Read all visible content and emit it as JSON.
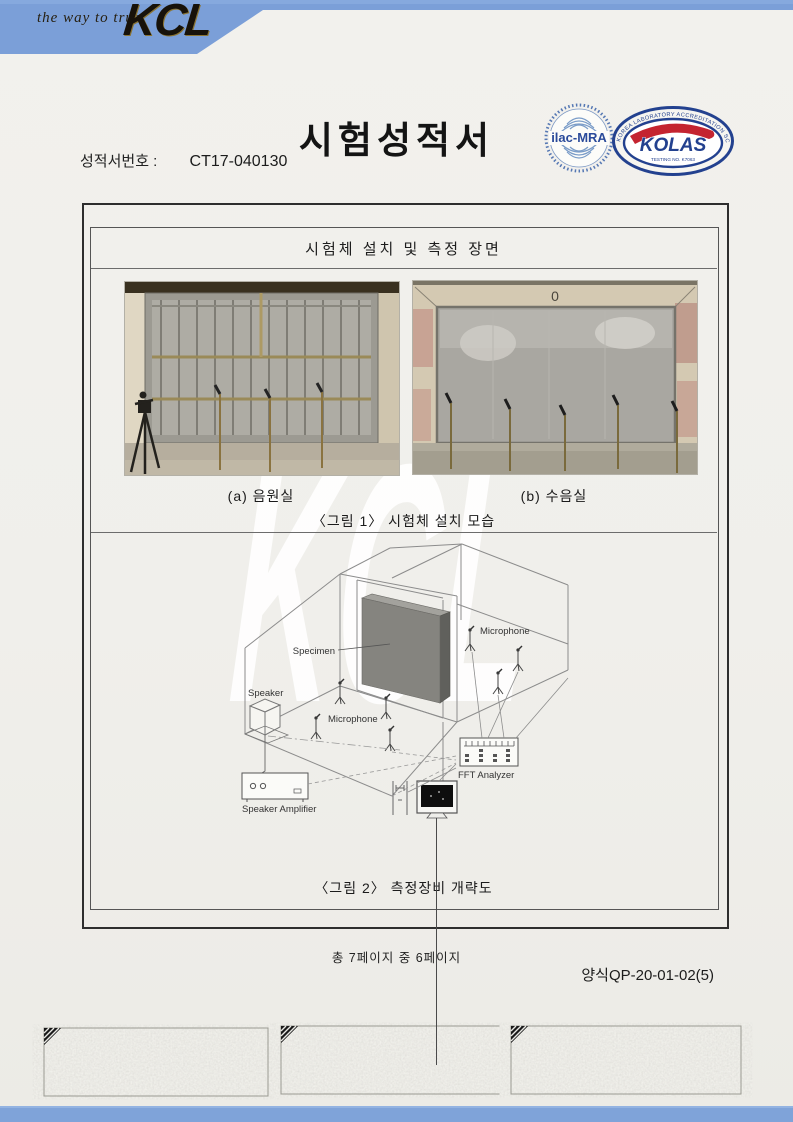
{
  "header": {
    "tagline": "the way to trust",
    "brand": "KCL"
  },
  "title": "시험성적서",
  "report": {
    "label": "성적서번호 :",
    "number": "CT17-040130"
  },
  "certifications": {
    "ilac": {
      "label": "ilac-MRA"
    },
    "kolas": {
      "name": "KOLAS",
      "ring_text": "KOREA LABORATORY ACCREDITATION SCHEME",
      "testing_no": "TESTING NO. K7063"
    }
  },
  "figure_box": {
    "title": "시험체 설치 및 측정 장면",
    "photos": {
      "a": {
        "caption": "(a) 음원실"
      },
      "b": {
        "caption": "(b) 수음실",
        "wall_mark": "0"
      }
    },
    "fig1_caption": "〈그림 1〉 시험체 설치 모습",
    "fig2_caption": "〈그림 2〉 측정장비 개략도",
    "diagram": {
      "labels": {
        "specimen": "Specimen",
        "microphone_receiving": "Microphone",
        "microphone_source": "Microphone",
        "speaker": "Speaker",
        "speaker_amplifier": "Speaker Amplifier",
        "fft_analyzer": "FFT Analyzer"
      }
    }
  },
  "footer": {
    "page_info": "총 7페이지 중 6페이지",
    "form_number": "양식QP-20-01-02(5)"
  },
  "watermark": "KCL",
  "colors": {
    "band_blue": "#7b9fd8",
    "kolas_navy": "#23418f",
    "kolas_red": "#c42430",
    "ilac_blue": "#2a4a9a"
  }
}
